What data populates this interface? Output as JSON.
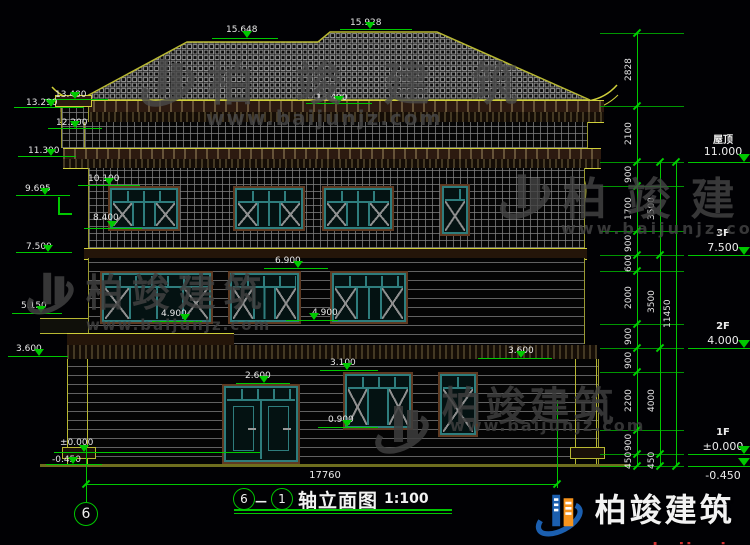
{
  "brand": {
    "name": "柏竣建筑",
    "url": "www.baijunjz.com"
  },
  "title": {
    "axis_start": "6",
    "axis_end": "1",
    "dash": "—",
    "name": "轴立面图",
    "scale": "1:100"
  },
  "axis_bubble": "6",
  "dims": {
    "total_width": "17760",
    "total_height": "11450",
    "chain_a": [
      "2828",
      "2100",
      "900",
      "1700",
      "900",
      "600",
      "2000",
      "900",
      "900",
      "2200",
      "900",
      "450"
    ],
    "chain_b": [
      "3500",
      "3500",
      "4000",
      "450"
    ]
  },
  "levels": {
    "roof": {
      "name": "屋顶",
      "value": "11.000"
    },
    "f3": {
      "name": "3F",
      "value": "7.500"
    },
    "f2": {
      "name": "2F",
      "value": "4.000"
    },
    "f1": {
      "name": "1F",
      "value": "±0.000"
    },
    "ground": "-0.450"
  },
  "elevations": {
    "ridge_left": "15.648",
    "ridge_right": "15.928",
    "eave_tip_a": "13.480",
    "eave_tip_b": "13.290",
    "eave_center": "13.400",
    "chimney": "12.200",
    "cornice": "11.300",
    "w3_top": "10.100",
    "bracket": "9.695",
    "w3_bottom": "8.400",
    "f3": "7.500",
    "w2_top": "6.900",
    "w2_sill": "4.900",
    "w2_sill_left": "4.900",
    "rail": "5.150",
    "band_left": "3.600",
    "band_right": "3.600",
    "w1_top": "3.100",
    "door_top": "2.600",
    "w1_sill": "0.900",
    "zero": "±0.000",
    "minus": "-0.450"
  },
  "colors": {
    "annotation": "#00c800",
    "outline": "#b8b832",
    "frame": "#2e7d7d",
    "logo_blue": "#1b5fb0",
    "logo_orange": "#f7941d",
    "url_red": "#d03030"
  }
}
